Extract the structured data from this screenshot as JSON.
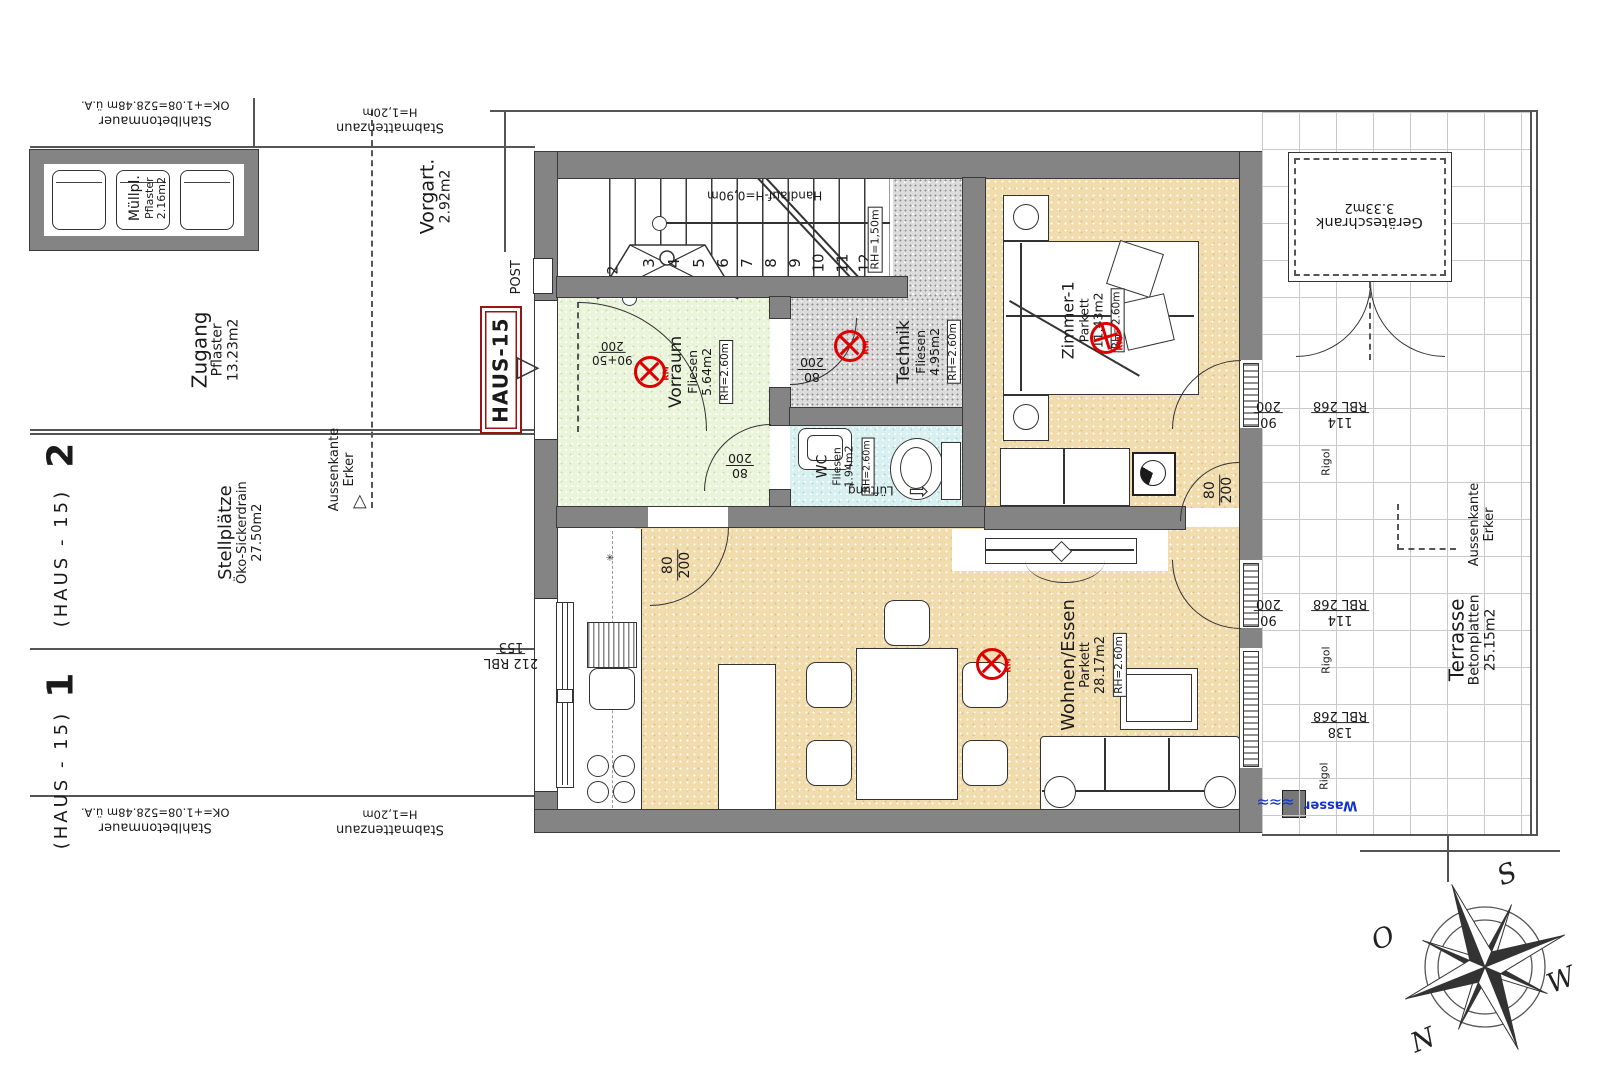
{
  "plan": {
    "site": {
      "stahlbetonmauer": {
        "name": "Stahlbetonmauer",
        "note": "OK=+1.08=528.48m ü.A."
      },
      "stabmattenzaun": {
        "name": "Stabmattenzaun",
        "note": "H=1,20m"
      },
      "muellplatz": {
        "name": "Müllpl.",
        "surface": "Pflaster",
        "area": "2.16m2"
      },
      "zugang": {
        "name": "Zugang",
        "surface": "Pflaster",
        "area": "13.23m2"
      },
      "vorgarten": {
        "name": "Vorgart.",
        "area": "2.92m2"
      },
      "stellplaetze": {
        "name": "Stellplätze",
        "surface": "Öko-Sickerdrain",
        "area": "27.50m2"
      },
      "stall2": {
        "number": "2",
        "house": "(HAUS - 15)"
      },
      "stall1": {
        "number": "1",
        "house": "(HAUS - 15)"
      },
      "aussenkante": {
        "line1": "Aussenkante",
        "line2": "Erker"
      },
      "post": "POST",
      "haus_tag": "HAUS-15"
    },
    "stairs": {
      "handlauf": "Handlauf-H=0,90m",
      "rh": "RH=1,50m",
      "steps": [
        "1",
        "2",
        "3",
        "4",
        "5",
        "6",
        "7",
        "8",
        "9",
        "10",
        "11",
        "12"
      ]
    },
    "rooms": {
      "vorraum": {
        "name": "Vorraum",
        "floor": "Fliesen",
        "area": "5.64m2",
        "rh": "RH=2.60m"
      },
      "technik": {
        "name": "Technik",
        "floor": "Fliesen",
        "area": "4.95m2",
        "rh": "RH=2.60m"
      },
      "wc": {
        "name": "WC",
        "floor": "Fliesen",
        "area": "1.94m2",
        "rh": "RH=2.60m"
      },
      "zimmer1": {
        "name": "Zimmer-1",
        "floor": "Parkett",
        "area": "11.43m2",
        "rh": "RH=2.60m"
      },
      "wohnen": {
        "name": "Wohnen/Essen",
        "floor": "Parkett",
        "area": "28.17m2",
        "rh": "RH=2.60m"
      },
      "geraeteschrank": {
        "name": "Geräteschrank",
        "area": "3.33m2"
      },
      "terrasse": {
        "name": "Terrasse",
        "surface": "Betonplatten",
        "area": "25.15m2"
      }
    },
    "dims": {
      "d80": "80",
      "d90": "90",
      "d200": "200",
      "d9050": "90+50",
      "d268": "268",
      "d114": "114",
      "d138": "138",
      "d212": "212",
      "d153": "153",
      "rbl": "RBL",
      "rigol": "Rigol"
    },
    "annotations": {
      "lueftung": "Lüftung",
      "wasser": "Wasser",
      "rm": "RM"
    },
    "compass": {
      "n": "N",
      "s": "S",
      "o": "O",
      "w": "W"
    },
    "icons": {
      "vent-arrow": "⇨",
      "direction-triangle": "▷",
      "water-wave": "≈≈≈",
      "kitchen-star": "✳"
    },
    "colors": {
      "wall": "#848484",
      "parkett": "#f1dcae",
      "fliesen_green": "#eaf4da",
      "fliesen_cyan": "#d8f0f0",
      "technik_gray": "#dcdcdc",
      "rm_red": "#dd0000",
      "haus_red": "#9b1414",
      "wasser_blue": "#1133cc"
    }
  }
}
